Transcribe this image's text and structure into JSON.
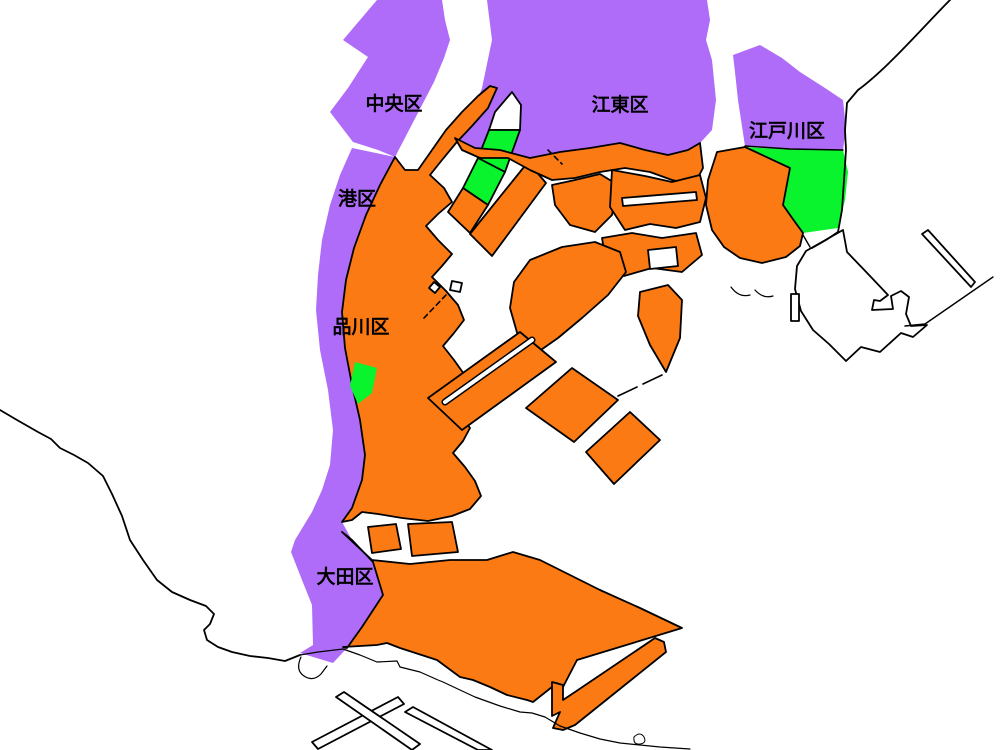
{
  "map": {
    "description": "Tokyo Bay waterfront ward map",
    "background": "#ffffff",
    "colors": {
      "purple": "#ae6cf8",
      "orange": "#fb7a14",
      "green": "#09f42d",
      "outline": "#000000",
      "white_land": "#ffffff"
    },
    "labels": [
      {
        "text": "中央区",
        "x": 394,
        "y": 110
      },
      {
        "text": "江東区",
        "x": 620,
        "y": 111
      },
      {
        "text": "江戸川区",
        "x": 787,
        "y": 137
      },
      {
        "text": "港区",
        "x": 357,
        "y": 205
      },
      {
        "text": "品川区",
        "x": 361,
        "y": 333
      },
      {
        "text": "大田区",
        "x": 345,
        "y": 583
      }
    ],
    "regions": [
      {
        "name": "region-chuo-mainland",
        "fill": "purple",
        "stroke": false,
        "path": "M377,0 L343,40 368,57 348,88 330,112 353,142 378,150 395,157 408,132 421,107 434,82 444,58 450,40 445,20 442,0 Z"
      },
      {
        "name": "region-minato-shinagawa-ota-strip",
        "fill": "purple",
        "stroke": false,
        "path": "M395,157 L352,148 340,175 330,205 322,240 318,275 316,310 320,350 328,390 333,430 330,465 322,490 312,512 295,540 291,552 302,580 312,605 313,645 300,653 333,663 347,648 362,627 383,595 373,562 352,540 342,522 352,508 362,480 365,455 360,420 352,385 345,348 342,312 346,280 354,248 366,215 380,185 Z"
      },
      {
        "name": "region-koto-mainland",
        "fill": "purple",
        "stroke": false,
        "path": "M487,0 L492,40 482,88 470,120 455,138 475,148 500,150 530,158 560,152 590,148 620,143 645,150 668,155 688,150 700,143 712,130 716,100 712,60 706,40 710,20 707,0 Z"
      },
      {
        "name": "region-edogawa-north",
        "fill": "purple",
        "stroke": false,
        "path": "M733,55 L760,45 782,58 800,72 825,88 843,100 846,128 843,150 800,150 760,148 745,146 738,100 735,72 Z"
      },
      {
        "name": "region-kasai-green",
        "fill": "green",
        "stroke": false,
        "path": "M745,147 L790,168 783,205 795,222 803,233 838,228 845,200 848,172 843,150 800,150 760,148 Z"
      },
      {
        "name": "region-kasai-orange",
        "fill": "orange",
        "stroke": true,
        "path": "M717,152 L745,147 790,168 783,205 795,222 803,233 800,246 786,257 762,263 740,258 724,247 712,230 706,205 708,180 Z"
      },
      {
        "name": "region-west-coastal-mass",
        "fill": "orange",
        "stroke": true,
        "path": "M497,88 L490,86 478,96 462,112 446,130 432,150 418,170 405,170 395,157 380,185 366,215 354,248 346,280 342,312 345,348 352,385 360,420 365,455 362,480 352,508 342,522 352,520 362,512 378,514 402,518 428,521 452,516 470,509 481,496 475,481 465,467 453,453 463,441 470,428 460,414 448,400 457,388 464,374 454,360 443,346 454,333 464,320 458,305 446,291 432,277 442,266 452,254 438,240 426,226 438,214 452,202 444,188 430,175 442,160 456,143 472,126 488,108 Z"
      },
      {
        "name": "region-south-big-mass",
        "fill": "orange",
        "stroke": true,
        "path": "M342,532 L372,560 410,564 450,560 487,560 513,552 540,560 570,575 600,590 640,608 682,628 577,660 563,687 557,683 533,702 527,700 507,695 490,687 473,680 460,677 437,660 400,648 387,643 377,645 343,647 347,648 362,627 383,595 373,562 352,540 Z"
      },
      {
        "name": "region-canal-island-1",
        "fill": "orange",
        "stroke": true,
        "path": "M368,527 L396,524 401,549 372,553 Z"
      },
      {
        "name": "region-canal-island-2",
        "fill": "orange",
        "stroke": true,
        "path": "M408,524 L452,522 458,552 412,556 Z"
      },
      {
        "name": "region-tsukishima-tip",
        "fill": "white_land",
        "stroke": true,
        "path": "M512,92 L521,105 520,130 489,130 495,112 Z"
      },
      {
        "name": "region-tsukishima-green-upper",
        "fill": "green",
        "stroke": true,
        "path": "M489,130 L520,130 505,172 478,158 Z"
      },
      {
        "name": "region-tsukishima-green-lower",
        "fill": "green",
        "stroke": true,
        "path": "M478,158 L505,172 488,205 463,188 Z"
      },
      {
        "name": "region-tsukishima-orange-tail",
        "fill": "orange",
        "stroke": true,
        "path": "M463,188 L488,205 470,233 448,212 Z"
      },
      {
        "name": "region-harumi-island",
        "fill": "orange",
        "stroke": true,
        "path": "M528,162 L546,183 492,256 470,234 Z"
      },
      {
        "name": "region-koto-coast-strip",
        "fill": "orange",
        "stroke": true,
        "path": "M455,138 L475,148 500,150 530,158 560,152 590,148 620,143 645,150 668,155 688,150 700,143 703,168 694,185 672,180 650,172 625,168 600,172 575,178 552,180 530,170 508,158 480,158 462,150 Z"
      },
      {
        "name": "region-toyosu-island",
        "fill": "orange",
        "stroke": true,
        "path": "M552,185 L575,180 600,174 618,185 612,215 595,232 570,225 555,205 Z"
      },
      {
        "name": "region-shinkiba-mass",
        "fill": "orange",
        "stroke": true,
        "path": "M612,170 L645,176 672,182 700,175 706,198 700,222 676,228 650,224 625,230 610,207 Z"
      },
      {
        "name": "region-shinkiba-channel",
        "fill": "white_land",
        "stroke": true,
        "path": "M622,198 L696,192 697,200 623,206 Z"
      },
      {
        "name": "region-yumenoshima-mass",
        "fill": "orange",
        "stroke": true,
        "path": "M602,238 L632,233 662,238 696,233 702,255 682,272 652,268 624,276 606,262 Z"
      },
      {
        "name": "region-yumenoshima-hole",
        "fill": "white_land",
        "stroke": true,
        "path": "M648,250 L676,247 678,266 650,269 Z"
      },
      {
        "name": "region-wakasu",
        "fill": "orange",
        "stroke": true,
        "path": "M640,292 L668,285 682,300 680,338 666,372 650,345 638,316 Z"
      },
      {
        "name": "region-ariake-mass",
        "fill": "orange",
        "stroke": true,
        "path": "M530,260 L562,247 595,242 620,252 626,272 608,295 582,318 558,338 538,352 518,336 510,308 514,282 Z"
      },
      {
        "name": "region-oi-pier-slab",
        "fill": "orange",
        "stroke": true,
        "path": "M428,398 L520,332 556,362 462,430 Z"
      },
      {
        "name": "region-aomi-diamond-1",
        "fill": "orange",
        "stroke": true,
        "path": "M526,408 L572,368 618,400 574,442 Z"
      },
      {
        "name": "region-aomi-diamond-2",
        "fill": "orange",
        "stroke": true,
        "path": "M586,452 L630,412 660,440 614,484 Z"
      },
      {
        "name": "region-shinagawa-green",
        "fill": "green",
        "stroke": false,
        "path": "M355,362 L377,368 372,393 358,404 350,386 Z"
      },
      {
        "name": "region-d-runway-strip",
        "fill": "orange",
        "stroke": true,
        "path": "M552,682 L563,685 563,700 575,692 655,638 664,642 666,652 575,725 563,730 553,728 560,712 552,716 Z"
      },
      {
        "name": "region-urayasu-outline",
        "fill": "white_land",
        "stroke": true,
        "path": "M843,230 L847,252 870,276 888,295 880,301 874,300 872,310 893,309 891,296 901,291 909,297 906,314 911,326 927,325 913,337 901,333 880,352 861,347 846,361 829,344 813,330 801,311 795,289 797,266 806,251 822,242 Z"
      },
      {
        "name": "region-urayasu-runway-strip",
        "fill": "white_land",
        "stroke": true,
        "path": "M922,234 L928,230 975,282 971,287 Z"
      },
      {
        "name": "region-haneda-runway-1",
        "fill": "white_land",
        "stroke": true,
        "path": "M312,742 L398,697 404,704 318,749 Z"
      },
      {
        "name": "region-haneda-runway-2",
        "fill": "white_land",
        "stroke": true,
        "path": "M336,697 L344,692 420,744 412,750 Z"
      },
      {
        "name": "region-haneda-runway-3",
        "fill": "white_land",
        "stroke": true,
        "path": "M405,712 L413,707 492,750 478,750 Z"
      },
      {
        "name": "region-islet-diamond",
        "fill": "white_land",
        "stroke": true,
        "path": "M434,282 L440,287 435,293 429,288 Z"
      },
      {
        "name": "region-islet-square",
        "fill": "white_land",
        "stroke": true,
        "path": "M452,281 L462,283 460,292 450,290 Z"
      },
      {
        "name": "region-kasai-rect-islet",
        "fill": "white_land",
        "stroke": true,
        "path": "M791,294 L799,294 799,321 791,321 Z"
      }
    ],
    "channels": [
      {
        "name": "channel-oi-slip",
        "path": "M445,402 L532,340",
        "outer": 7,
        "inner": 4
      }
    ],
    "lines": [
      {
        "name": "coast-chiba-northeast",
        "path": "M950,0 C925,25 888,68 858,90 L847,103 845,130 846,150 844,180 842,210 838,232 L826,240 812,248",
        "width": 1.8,
        "dashed": false
      },
      {
        "name": "coast-urayasu-diagonal",
        "path": "M993,277 L925,324 905,326",
        "width": 1.4,
        "dashed": false
      },
      {
        "name": "coast-mainland-southwest",
        "path": "M0,410 L17,420 38,432 51,439 60,448 74,455 88,463 103,476 112,494 122,516 130,540 143,560 157,580 172,592 190,600 206,606 214,614 210,624 204,630 207,640 218,647 232,652 250,656 268,658 285,661 300,655",
        "width": 1.8,
        "dashed": false
      },
      {
        "name": "coast-kawasaki-haneda",
        "path": "M300,655 L318,652 343,649 360,655 377,662 397,661 400,667 420,672 438,680 443,682 460,690 475,697 500,706 520,712 532,713 545,717 560,726 580,733 600,739 620,743 640,745 660,747 690,749",
        "width": 1.2,
        "dashed": false
      },
      {
        "name": "coast-haneda-harbor",
        "path": "M301,657 Q295,670 304,676 Q313,682 321,674 L327,666",
        "width": 1.2,
        "dashed": false
      },
      {
        "name": "coast-haneda-loop",
        "path": "M634,737 Q640,731 644,737 Q647,743 640,744 Q633,745 634,737",
        "width": 1.0,
        "dashed": false
      },
      {
        "name": "coast-kasai-beach-arc-1",
        "path": "M731,287 Q739,298 750,295",
        "width": 1.2,
        "dashed": false
      },
      {
        "name": "coast-kasai-beach-arc-2",
        "path": "M755,290 Q763,299 773,296",
        "width": 1.2,
        "dashed": false
      },
      {
        "name": "bridge-gate-east",
        "path": "M662,375 L643,384",
        "width": 1.6,
        "dashed": false
      },
      {
        "name": "bridge-gate-west",
        "path": "M637,387 L618,396",
        "width": 1.6,
        "dashed": false
      },
      {
        "name": "breakwater-dashed-west",
        "path": "M446,295 L424,318",
        "width": 1.6,
        "dashed": true
      },
      {
        "name": "breakwater-dashed-harumi",
        "path": "M548,150 L562,164",
        "width": 1.6,
        "dashed": true
      },
      {
        "name": "edogawa-river-line",
        "path": "M745,146 L790,149 843,150",
        "width": 1.4,
        "dashed": false
      },
      {
        "name": "kasai-to-urayasu-link",
        "path": "M803,235 L810,247",
        "width": 1.4,
        "dashed": false
      }
    ]
  }
}
